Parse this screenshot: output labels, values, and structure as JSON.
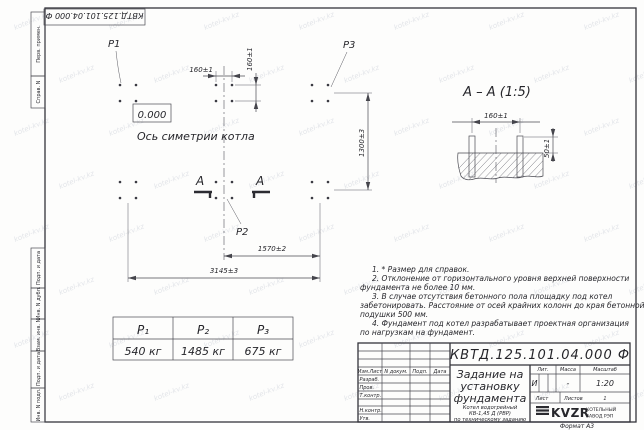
{
  "watermark": {
    "text": "kotel-kv.kz"
  },
  "doc": {
    "number_full": "КВТД.125.101.04.000  Ф"
  },
  "margin": {
    "items": [
      "Перв. примен.",
      "Справ. N",
      "Подп. и дата",
      "Инв. N дубл.",
      "Взам. инв. N",
      "Подп. и дата",
      "Инв. N подл."
    ]
  },
  "plan": {
    "p1": "P1",
    "p2": "P2",
    "p3": "P3",
    "level": "0.000",
    "axis_label": "Ось симетрии котла",
    "section_letter": "А",
    "dim_160h": "160±1",
    "dim_160v": "160±1",
    "dim_1300": "1300±3",
    "dim_1570": "1570±2",
    "dim_3145": "3145±3"
  },
  "section": {
    "title": "А – А (1:5)",
    "dim_160": "160±1",
    "dim_50": "50±1"
  },
  "load_table": {
    "headers": [
      "P₁",
      "P₂",
      "P₃"
    ],
    "values": [
      "540 кг",
      "1485 кг",
      "675 кг"
    ]
  },
  "notes": {
    "lines": [
      "1. * Размер для справок.",
      "2. Отклонение от горизонтального уровня верхней поверхности",
      "фундамента не более 10 мм.",
      "3. В случае отсутствия бетонного пола площадку под котел",
      "забетонировать. Расстояние от осей крайних колонн до края бетонной",
      "подушки 500 мм.",
      "4. Фундамент под котел разрабатывает проектная организация",
      "по нагрузкам на фундамент."
    ]
  },
  "title_block": {
    "header_izm": "Изм.Лист",
    "header_doc": "N докум.",
    "header_podp": "Подп.",
    "header_data": "Дата",
    "row_razrab": "Разраб.",
    "row_prov": "Пров.",
    "row_tkontr": "Т.контр.",
    "row_nkontr": "Н.контр.",
    "row_utv": "Утв.",
    "title_line1": "Задание на",
    "title_line2": "установку",
    "title_line3": "фундамента",
    "subtitle_line1": "Котел водогрейный",
    "subtitle_line2": "КВ-1,45 Д (РВР)",
    "subtitle_line3": "по техническому заданию",
    "lit_label": "Лит.",
    "mass_label": "Масса",
    "scale_label": "Масштаб",
    "lit_value": "И",
    "mass_value": "-",
    "scale_value": "1:20",
    "sheet_label": "Лист",
    "sheets_label": "Листов",
    "sheets_value": "1",
    "logo_text": "KVZR",
    "logo_caption_1": "КОТЕЛЬНЫЙ",
    "logo_caption_2": "ЗАВОД РЭП",
    "format_label": "Формат А3"
  }
}
